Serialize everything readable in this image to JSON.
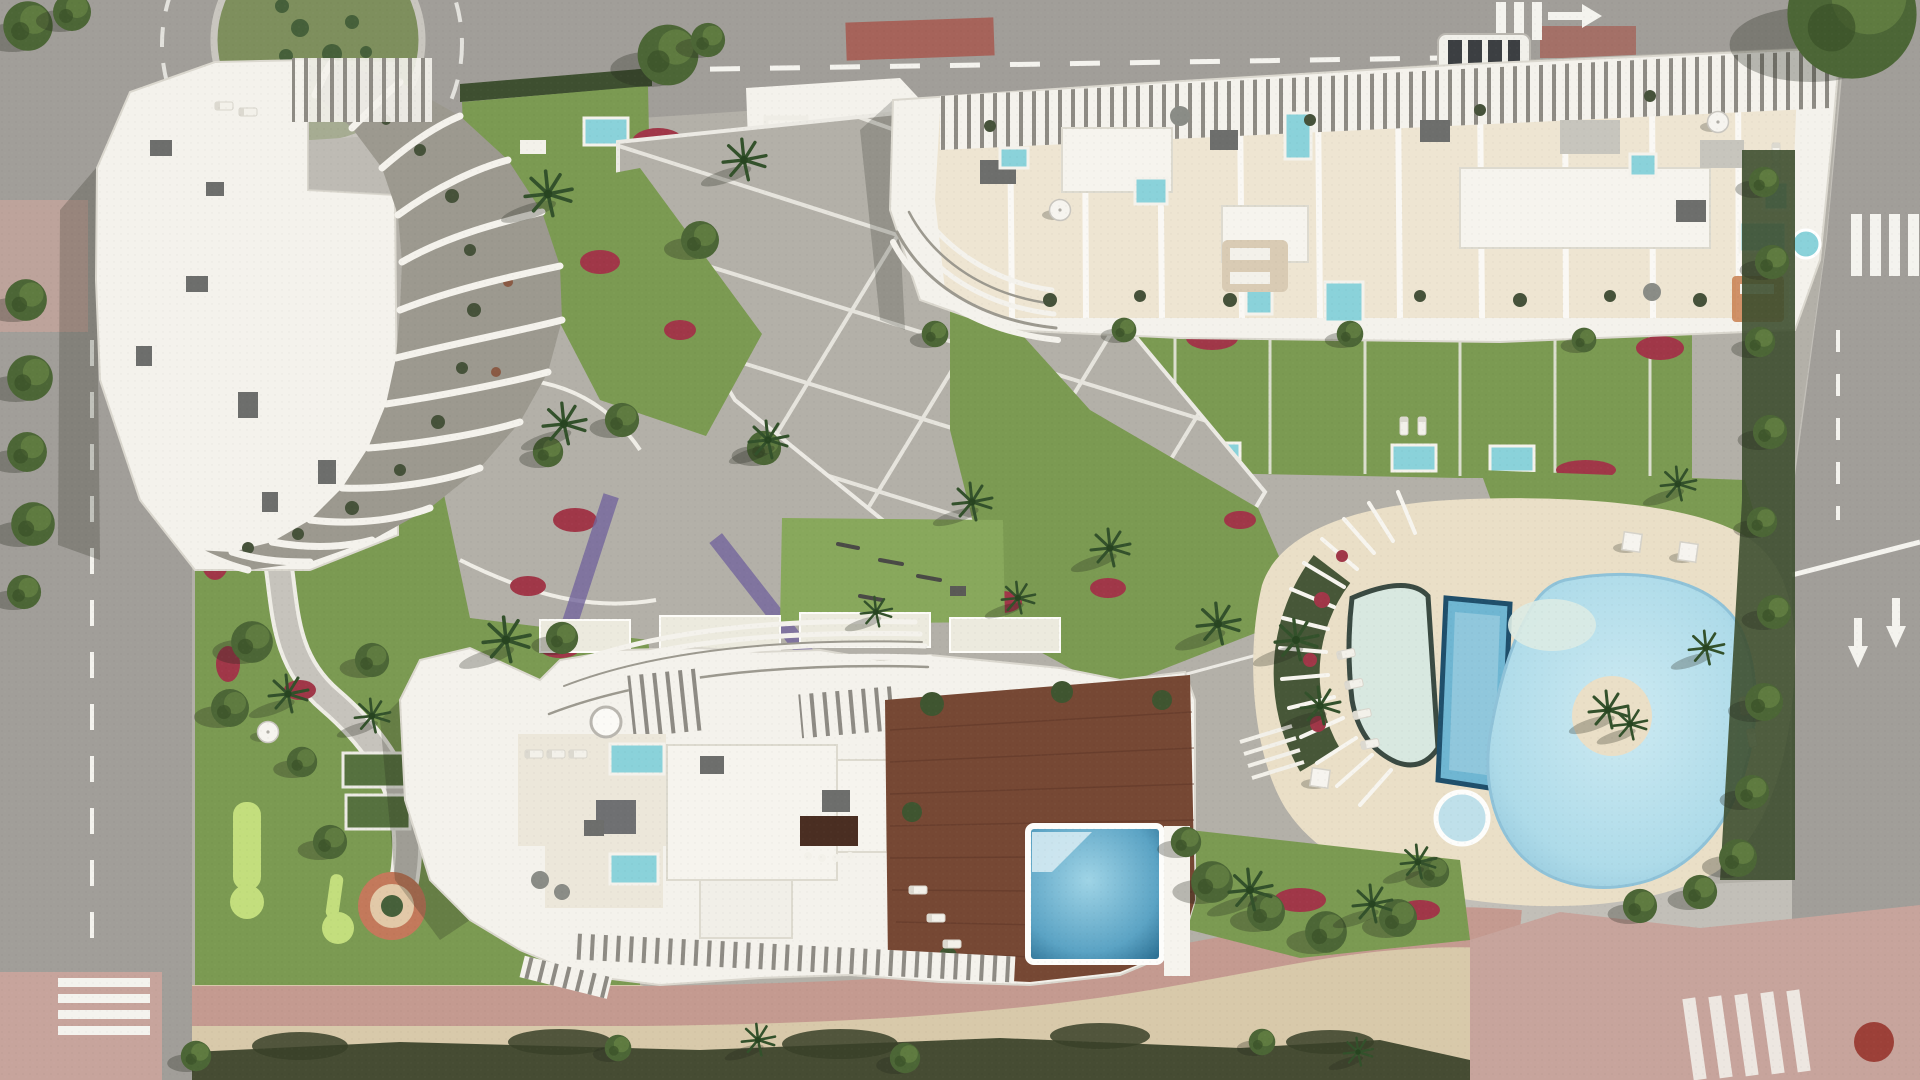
{
  "scene": {
    "type": "aerial-architectural-render",
    "elements": [
      "roundabout",
      "roundabout-island",
      "left-road",
      "top-road",
      "right-road",
      "zebra-crosswalks",
      "lane-markings",
      "shuttle-bus",
      "residential-site",
      "curved-rib-building-northwest",
      "terrace-building-northeast",
      "organic-building-south",
      "rooftop-plunge-pools",
      "rooftop-wood-deck",
      "rooftop-infinity-pool",
      "lagoon-pool",
      "lap-pool",
      "beach-entry-pool",
      "jacuzzi",
      "pool-island",
      "sun-deck",
      "pergola-fan",
      "central-plaza",
      "garden-paths",
      "mini-golf-greens",
      "petanque-courts",
      "terracotta-circle",
      "gym-lawn",
      "flower-beds",
      "palm-trees",
      "hedges",
      "parasols",
      "sun-loungers",
      "beach-sand-strip",
      "pink-promenade"
    ]
  },
  "colors": {
    "asphalt": "#a19e99",
    "asphalt2": "#918e8a",
    "pavement": "#c2bfb8",
    "paving": "#b3b0a8",
    "paving_light": "#c9c6bf",
    "curb_white": "#efede6",
    "lane_white": "#f4f3ee",
    "island_green": "#7e8f5d",
    "lawn": "#7b9a52",
    "lawn_bright": "#88a85c",
    "putting": "#c3de7d",
    "hedge": "#3e4f30",
    "veg_dark": "#3a4129",
    "tree": "#4c6636",
    "tree_light": "#6a8746",
    "palm": "#33512b",
    "flower_red": "#a03748",
    "flower_purple": "#73659c",
    "bldg_white": "#f4f2ec",
    "bldg_edge": "#dbd8cf",
    "rib_shadow": "#9c998f",
    "roof_cream": "#eee5d2",
    "terrace_cream": "#ece7da",
    "ac_gray": "#6d6e6c",
    "slab_gray": "#c7c5bd",
    "wood": "#764834",
    "wood_dark": "#5d3627",
    "pool_cyan": "#8ad2da",
    "pool_blue": "#6fb6d2",
    "pool_rim": "#1f4f6b",
    "pool_deep": "#2f7396",
    "lagoon": "#aedbe9",
    "pool_pale": "#d8e8e0",
    "water_light": "#cfe9f2",
    "sand": "#d8c9aa",
    "sand_deck": "#eadfc7",
    "promenade_pink": "#c49a90",
    "sidewalk_pink": "#c7a49c",
    "red_pavement": "#a84a3e",
    "bus_white": "#f1f0ea",
    "shadowc": "rgba(35,40,30,0.30)"
  }
}
